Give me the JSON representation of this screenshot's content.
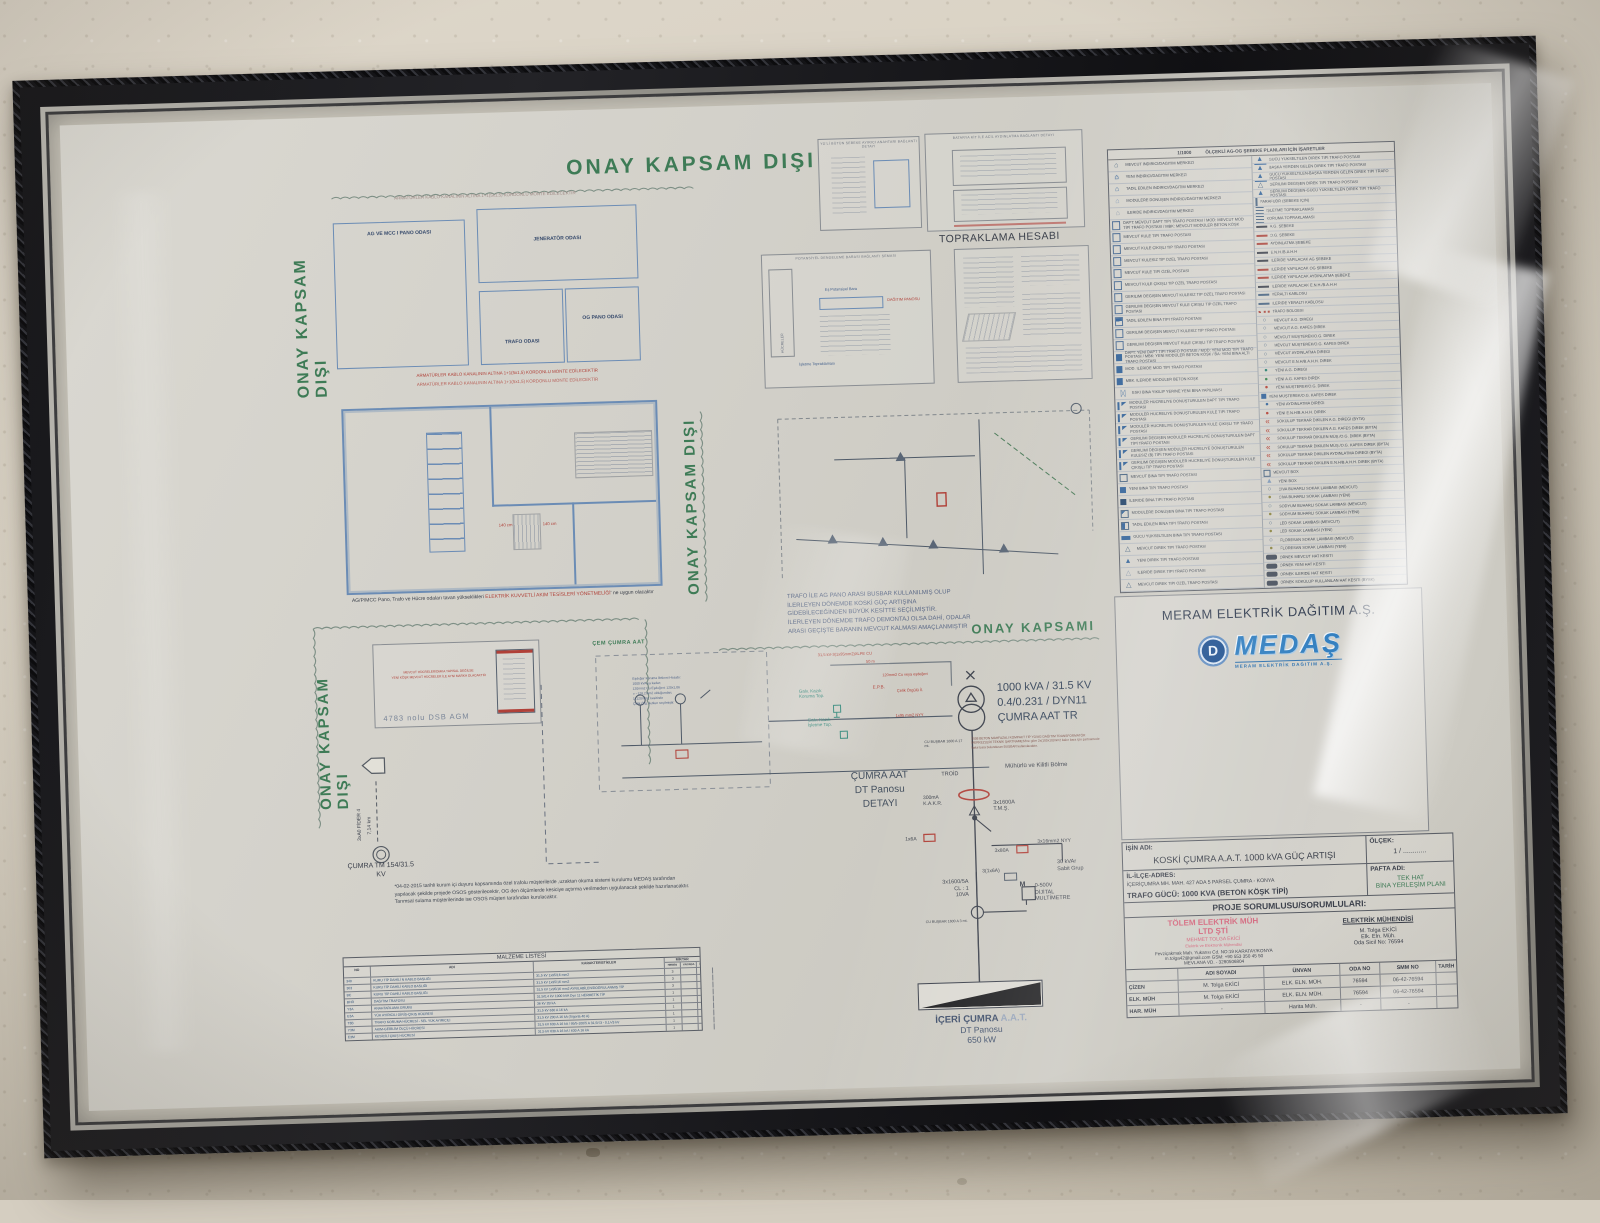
{
  "colors": {
    "stamp_green": "#3e7b56",
    "plan_blue": "#6b8cb5",
    "accent_red": "#b04038",
    "logo_blue": "#2f7dbf",
    "pink": "#d4697f"
  },
  "stamps": {
    "top": "ONAY KAPSAM DIŞI",
    "left": "ONAY KAPSAM DIŞI",
    "mid": "ONAY KAPSAM DIŞI",
    "bottom_left": "ONAY KAPSAM DIŞI",
    "scope": "ONAY KAPSAMI"
  },
  "plan1": {
    "note_top": "ARMATÜRLER KABLO KANALININ ALTINA 1+1(5x1,5) KORDONLU MONTE EDİLECEKTİR",
    "rooms": {
      "r1": "AG VE MCC I PANO ODASI",
      "r2": "JENERATÖR ODASI",
      "r3": "TRAFO ODASI",
      "r4": "OG PANO ODASI"
    },
    "note_bottom1": "ARMATÜRLER KABLO KANALININ ALTINA 1+1(5x1,5) KORDONLU MONTE EDİLECEKTİR",
    "note_bottom2": "ARMATÜRLER KABLO KANALININ ALTINA 1+1(5x1,5) KORDONLU MONTE EDİLECEKTİR"
  },
  "plan2": {
    "caption_pre": "AG/P/MCC Pano, Trafo ve Hücre odaları tavan yükseklikleri ",
    "caption_red": "ELEKTRİK KUVVETLİ AKIM TESİSLERİ YÖNETMELİĞİ",
    "caption_post": "' ne uygun olacaktır",
    "dim1": "140 cm",
    "dim2": "140 cm"
  },
  "details": {
    "box_a_title": "YG'Lİ BÜTÜN ŞEBEKE AYIRICI ANAHTARI BAĞLANTI DETAYI",
    "box_b_title": "BATARYA KİT İLE ACİL AYDINLATMA BAĞLANTI DETAYI",
    "gnd_label": "TOPRAKLAMA HESABI",
    "box_c_title": "POTANSİYEL DENGELEME BARASI BAĞLANTI ŞEMASI",
    "box_c_hucreler": "HÜCRELER",
    "box_c_bara": "Eş Potansiyel Bara",
    "box_c_pano": "DAĞITIM PANOSU",
    "box_c_gnd": "İşletme Topraklaması"
  },
  "feeder": {
    "line": "3xA0 FİDER 4",
    "len": "7,14 km",
    "tm1": "ÇUMRA TM 154/31.5",
    "tm2": "KV"
  },
  "dsb": {
    "label": "4783 nolu DSB AGM",
    "red1": "MEVCUT HÜCRELER/DMKA YAPISAL DEĞİLSE",
    "red2": "YENİ KÖŞK MEVCUT HÜCRELER İLE AYNI MARKA OLACAKTIR"
  },
  "notes_lines": [
    "TRAFO İLE AG PANO ARASI BUSBAR KULLANILMIŞ OLUP",
    "İLERLEYEN DÖNEMDE KOSKİ GÜÇ ARTIŞINA",
    "GİDEBİLECEĞİNDEN BÜYÜK KESİTTE SEÇİLMİŞTİR.",
    "İLERLEYEN DÖNEMDE TRAFO DEMONTAJ OLSA DAHİ, ODALAR",
    "ARASI GEÇİŞTE BARANIN MEVCUT KALMASI AMAÇLANMIŞTIR"
  ],
  "schematic": {
    "cem": "ÇEM ÇUMRA AAT",
    "esdeger": [
      "Eşdeğer Koruma İletkeni Hesabı:",
      "1000 kVA ya kadar;",
      "120mm2 Cu Eşdeğeri: 120x1,06",
      "= ~128,2mm2 olduğundan;",
      "1x120mm2 kesitinde",
      "Çelik Örg. iletken seçilmiştir."
    ],
    "cable_top1": "31,5 kV-3(1x95mm2)XLPE CU",
    "cable_top2": "50 m",
    "koruma1": "Galv. Kazık",
    "koruma2": "Koruma Top.",
    "epb": "E.P.B.",
    "celik": "Çelik Örgülü İl.",
    "cu120": "120mm2 Cu veya eşdeğeri",
    "isletme1": "Galv. Kazık",
    "isletme2": "İşletme Top.",
    "nyy95": "1x95 mm2 NYY",
    "spec1": "1000 kVA / 31.5 KV",
    "spec2": "0.4/0.231 / DYN11",
    "spec3": "ÇUMRA AAT TR",
    "busbar17": "CU BUŞBAR 1600 A 17 mt.",
    "sartname": "2008 BETON MAHFAZALI KOMPAKT TİP YG/AG DAĞITIM TRANSFORMATÖR MERKEZLERİ TEKNİK ŞARTNAMESİ'ne göre 2x(100x10)mm2 bakır bara için şartnamede bakır bara bulunduran BUSBAR kullanılacaktır.",
    "muhurlu": "Mühürlü ve Kilitli Bölme",
    "troid": "TROİD",
    "kakr1": "300mA",
    "kakr2": "K.A.K.R.",
    "tms1": "3x1600A",
    "tms2": "T.M.Ş.",
    "f1": "1x6A",
    "f2": "3x80A",
    "nyy16": "3x16mm2 NYY",
    "f3": "3(1x6A)",
    "mm1": "0-500V",
    "mm2": "DİJİTAL",
    "mm3": "MULTİMETRE",
    "multimeter_m": "M",
    "ct1": "3x1600/5A",
    "ct2": "CL : 1",
    "ct3": "10VA",
    "kvar1": "30 kVAr",
    "kvar2": "Sabit Grup",
    "busbar3": "CU BUŞBAR 1600 A 3 mt.",
    "dt1": "ÇUMRA AAT",
    "dt2": "DT Panosu",
    "dt3": "DETAYI"
  },
  "load": {
    "name": "İÇERİ ÇUMRA",
    "suffix": "A.A.T.",
    "line2": "DT Panosu",
    "line3": "650 kW"
  },
  "osos_note": [
    "*04-02-2015 tarihli kurum içi duyuru kapsamında özel trafolu müşterilerde ,uzaktan okuma sistemi kurulumu MEDAŞ tarafından",
    "yapılacak şekilde projede OSOS gösterilecektir, OG den ölçümlerde kesiciye açtırma verilmeden uygulanacak şekilde hazırlanacaktır.",
    "Tarımsal sulama müşterilerinde ise OSOS müşteri tarafından kurulacaktır."
  ],
  "materials": {
    "title": "MALZEME LİSTESİ",
    "h_no": "NO",
    "h_adi": "ADI",
    "h_kar": "KARAKTERİSTİKLER",
    "h_miktar": "MİKTAR",
    "h_q": [
      "HEMEN",
      "YAKINDA",
      "İLERİDE",
      "MEVCUT"
    ],
    "rows": [
      {
        "no": "340",
        "adi": "KURU TİP DAHİLİ N KABLO BAŞLIĞI",
        "kar": "31,5 kV 1x95/16 mm2",
        "q": "3"
      },
      {
        "no": "303",
        "adi": "KURU TİP DAHİLİ KABLO BAŞLIĞI",
        "kar": "31,5 kV 1x95/16 mm2",
        "q": "3"
      },
      {
        "no": "BC",
        "adi": "KURU TİP DAHİLİ KABLO BAŞLIĞI",
        "kar": "31,5 kV 1x95/16 mm2 AYRILABİLEN/DOĞRULANMIŞ TİP",
        "q": "3"
      },
      {
        "no": "BHR",
        "adi": "DAĞITIM TRAFOSU",
        "kar": "31,5/0,4 kV 1000 kVA Dyn 11 HERMETİK TİP",
        "q": "1"
      },
      {
        "no": "Y3A",
        "adi": "ANAHTARLAMA GRUBU",
        "kar": "36 kV 2B kA",
        "q": "1"
      },
      {
        "no": "E3A",
        "adi": "YÜK AYIRICILI GİRİŞ-ÇIKIŞ HÜCRESİ",
        "kar": "31,5 kV 630 A 16 kA",
        "q": "1"
      },
      {
        "no": "T3B",
        "adi": "TRAFO KORUMA HÜCRESİ - SEL YÜK AYIRICILI",
        "kar": "31,5 kV 200 A 16 kA (Sigorta 40 A)",
        "q": "1"
      },
      {
        "no": "Y3M",
        "adi": "AKIM-GERİLİM ÖLÇÜ HÜCRESİ",
        "kar": "31,5 kV 630 A 16 kA / 95/5-100/5 A 31,5/√3 - 0,1/√3 kV",
        "q": "1"
      },
      {
        "no": "E3M",
        "adi": "KESİCİLİ ÇIKIŞ HÜCRESİ",
        "kar": "31,5 kV 630 A 16 kA / 630 A 16 kA",
        "q": "1"
      }
    ]
  },
  "legend": {
    "scale": "1/1000",
    "header": "ÖLÇEKLİ AG-OG ŞEBEKE PLANLARI İÇİN İŞARETLER",
    "left": [
      {
        "icon": "house-o",
        "label": "MEVCUT İNDİRİCİ/DAĞITIM MERKEZİ"
      },
      {
        "icon": "house-f",
        "label": "YENİ İNDİRİCİ/DAĞITIM MERKEZİ"
      },
      {
        "icon": "house-h",
        "label": "TADİL EDİLEN İNDİRİCİ/DAĞITIM MERKEZİ"
      },
      {
        "icon": "house-tri",
        "label": "MODÜLERE DÖNÜŞEN İNDİRİCİ/DAĞITIM MERKEZİ"
      },
      {
        "icon": "house-d",
        "label": "İLERİDE İNDİRİCİ/DAĞITIM MERKEZİ"
      },
      {
        "icon": "kiosk-o",
        "label": "DAPT: MEVCUT DAPT TİPİ TRAFO POSTASI / MOD: MEVCUT MOD TİPİ TRAFO POSTASI / MBK: MEVCUT MODÜLER BETON KÖŞK"
      },
      {
        "icon": "kiosk-o",
        "label": "MEVCUT KULE TİPİ TRAFO POSTASI"
      },
      {
        "icon": "kiosk-o",
        "label": "MEVCUT KULE ÇIKIŞLI TİP TRAFO POSTASI"
      },
      {
        "icon": "kiosk-o",
        "label": "MEVCUT KULESİZ TİP ÖZEL TRAFO POSTASI"
      },
      {
        "icon": "kiosk-o",
        "label": "MEVCUT KULE TİPİ ÖZEL POSTASI"
      },
      {
        "icon": "kiosk-o",
        "label": "MEVCUT KULE ÇIKIŞLI TİP ÖZEL TRAFO POSTASI"
      },
      {
        "icon": "kiosk-o",
        "label": "GERİLİMİ DEĞİŞEN MEVCUT KULESİZ TİP ÖZEL TRAFO POSTASI"
      },
      {
        "icon": "kiosk-o",
        "label": "GERİLİMİ DEĞİŞEN MEVCUT KULE ÇIKIŞLI TİP ÖZEL TRAFO POSTASI"
      },
      {
        "icon": "kiosk-h",
        "label": "TADİL EDİLEN BİNA TİPİ TRAFO POSTASI"
      },
      {
        "icon": "kiosk-o",
        "label": "GERİLİMİ DEĞİŞEN MEVCUT KULESİZ TİP TRAFO POSTASI"
      },
      {
        "icon": "kiosk-o",
        "label": "GERİLİMİ DEĞİŞEN MEVCUT KULE ÇIKIŞLI TİP TRAFO POSTASI"
      },
      {
        "icon": "kiosk-f",
        "label": "DAPT: YENİ DAPT TİPİ TRAFO POSTASI / MOD: YENİ MOD TİPİ TRAFO POSTASI / MBK: YENİ MODÜLER BETON KÖŞK / BA: YENİ BİNA ALTI TRAFO POSTASI"
      },
      {
        "icon": "kiosk-f",
        "label": "MOD. İLERİDE MOD TİPİ TRAFO POSTASI"
      },
      {
        "icon": "kiosk-f",
        "label": "MBK. İLERİDE MODÜLER BETON KÖŞK"
      },
      {
        "icon": "bowtie",
        "label": "ESKİ BİNA YIKILIP YERİNE YENİ BİNA YAPILMASI"
      },
      {
        "icon": "flag",
        "label": "MODÜLER HÜCRELİYE DÖNÜŞTÜRÜLEN DAPT TİPİ TRAFO POSTASI"
      },
      {
        "icon": "flag",
        "label": "MODÜLER HÜCRELİYE DÖNÜŞTÜRÜLEN KULE TİPİ TRAFO POSTASI"
      },
      {
        "icon": "flag",
        "label": "MODÜLER HÜCRELİYE DÖNÜŞTÜRÜLEN KULE ÇIKIŞLI TİP TRAFO POSTASI"
      },
      {
        "icon": "flag",
        "label": "GERİLİMİ DEĞİŞEN MODÜLER HÜCRELİYE DÖNÜŞTÜRÜLEN DAPT TİPİ TRAFO POSTASI"
      },
      {
        "icon": "flag",
        "label": "GERİLİMİ DEĞİŞEN MODÜLER HÜCRELİYE DÖNÜŞTÜRÜLEN KULESİZ (B) TİPİ TRAFO POSTASI"
      },
      {
        "icon": "flag",
        "label": "GERİLİMİ DEĞİŞEN MODÜLER HÜCRELİYE DÖNÜŞTÜRÜLEN KULE ÇIKIŞLI TİP TRAFO POSTASI"
      },
      {
        "icon": "sq-o",
        "label": "MEVCUT BİNA TİPİ TRAFO POSTASI"
      },
      {
        "icon": "sq-f",
        "label": "YENİ BİNA TİPİ TRAFO POSTASI"
      },
      {
        "icon": "sq-fd",
        "label": "İLERİDE BİNA TİPİ TRAFO POSTASI"
      },
      {
        "icon": "sq-tri",
        "label": "MODÜLERE DÖNÜŞEN BİNA TİPİ TRAFO POSTASI"
      },
      {
        "icon": "sq-h",
        "label": "TADİL EDİLEN BİNA TİPİ TRAFO POSTASI"
      },
      {
        "icon": "sq-bar",
        "label": "GÜCÜ YÜKSELTİLEN BİNA TİPİ TRAFO POSTASI"
      },
      {
        "icon": "tri-o",
        "label": "MEVCUT DİREK TİPİ TRAFO POSTASI"
      },
      {
        "icon": "tri-f",
        "label": "YENİ DİREK TİPİ TRAFO POSTASI"
      },
      {
        "icon": "tri-d",
        "label": "İLERİDE DİREK TİPİ TRAFO POSTASI"
      },
      {
        "icon": "tri-o",
        "label": "MEVCUT DİREK TİPİ ÖZEL TRAFO POSTASI"
      }
    ],
    "right": [
      {
        "icon": "tri-bar",
        "label": "GÜCÜ YÜKSELTİLEN DİREK TİPİ TRAFO POSTASI"
      },
      {
        "icon": "tri-f",
        "label": "BAŞKA YERDEN GELEN DİREK TİPİ TRAFO POSTASI"
      },
      {
        "icon": "tri-bar",
        "label": "GÜCÜ YÜKSELTİLEN-BAŞKA YERDEN GELEN DİREK TİPİ TRAFO POSTASI"
      },
      {
        "icon": "tri-o",
        "label": "GERİLİMİ DEĞİŞEN DİREK TİPİ TRAFO POSTASI"
      },
      {
        "icon": "tri-f",
        "label": "GERİLİMİ DEĞİŞEN-GÜCÜ YÜKSELTİLEN DİREK TİPİ TRAFO POSTASI"
      },
      {
        "icon": "para",
        "label": "PARAFUDR (ŞEBEKE İÇİN)"
      },
      {
        "icon": "gnd",
        "label": "İŞLETME TOPRAKLAMASI"
      },
      {
        "icon": "gnd",
        "label": "KORUMA TOPRAKLAMASI"
      },
      {
        "icon": "line-d",
        "label": "A.G. ŞEBEKE"
      },
      {
        "icon": "line-r",
        "label": "O.G. ŞEBEKE"
      },
      {
        "icon": "line-r",
        "label": "AYDINLATMA ŞEBEKE"
      },
      {
        "icon": "line-d",
        "label": "E.N.H./B.A.H.H"
      },
      {
        "icon": "dash-d",
        "label": "İLERİDE YAPILACAK AG ŞEBEKE"
      },
      {
        "icon": "dash-r",
        "label": "İLERİDE YAPILACAK OG ŞEBEKE"
      },
      {
        "icon": "dash-r",
        "label": "İLERİDE YAPILACAK AYDINLATMA ŞEBEKE"
      },
      {
        "icon": "dash-d",
        "label": "İLERİDE YAPILACAK E.N.H./B.A.H.H"
      },
      {
        "icon": "dash-m",
        "label": "YERALTI KABLOSU"
      },
      {
        "icon": "dash-m",
        "label": "İLERİDE YERALTI KABLOSU"
      },
      {
        "icon": "dot-l",
        "label": "TRAFO BÖLGESİ"
      },
      {
        "icon": "circ",
        "label": "MEVCUT A.G. DİREĞİ"
      },
      {
        "icon": "circ",
        "label": "MEVCUT A.G. KAFES DİREK"
      },
      {
        "icon": "circ",
        "label": "MEVCUT MÜŞTEREK/O.G. DİREK"
      },
      {
        "icon": "circ",
        "label": "MEVCUT MÜŞTEREK/O.G. KAFES DİREK"
      },
      {
        "icon": "circ",
        "label": "MEVCUT AYDINLATMA DİREĞİ"
      },
      {
        "icon": "circ",
        "label": "MEVCUT E.N.H/B.A.H.H. DİREK"
      },
      {
        "icon": "dot-t",
        "label": "YENİ A.G. DİREĞİ"
      },
      {
        "icon": "dot-g",
        "label": "YENİ A.G. KAFES DİREK"
      },
      {
        "icon": "dot-r",
        "label": "YENİ MÜŞTEREK/O.G. DİREK"
      },
      {
        "icon": "sq-f-sm",
        "label": "YENİ MÜŞTEREK/O.G. KAFES DİREK"
      },
      {
        "icon": "dot-b",
        "label": "YENİ AYDINLATMA DİREĞİ"
      },
      {
        "icon": "dot-r",
        "label": "YENİ E.N.H/B.A.H.H. DİREK"
      },
      {
        "icon": "chev",
        "label": "SÖKÜLÜP TEKRAR DİKİLEN A.G. DİREĞİ (BYTA)"
      },
      {
        "icon": "chev",
        "label": "SÖKÜLÜP TEKRAR DİKİLEN A.G. KAFES DİREK (BYTA)"
      },
      {
        "icon": "chev",
        "label": "SÖKÜLÜP TEKRAR DİKİLEN MÜŞ./O.G. DİREK (BYTA)"
      },
      {
        "icon": "chev",
        "label": "SÖKÜLÜP TEKRAR DİKİLEN MÜŞ./O.G. KAFES DİREK (BYTA)"
      },
      {
        "icon": "chev",
        "label": "SÖKÜLÜP TEKRAR DİKİLEN AYDINLATMA DİREĞİ (BYTA)"
      },
      {
        "icon": "chev",
        "label": "SÖKÜLÜP TEKRAR DİKİLEN E.N.H/B.A.H.H. DİREK (BYTA)"
      },
      {
        "icon": "sq-o-sm",
        "label": "MEVCUT BOX"
      },
      {
        "icon": "tri-h",
        "label": "YENİ BOX"
      },
      {
        "icon": "circ",
        "label": "CİVA BUHARLI SOKAK LAMBASI (MEVCUT)"
      },
      {
        "icon": "dot-y",
        "label": "CİVA BUHARLI SOKAK LAMBASI (YENİ)"
      },
      {
        "icon": "circ",
        "label": "SODYUM BUHARLI SOKAK LAMBASI (MEVCUT)"
      },
      {
        "icon": "dot-y",
        "label": "SODYUM BUHARLI SOKAK LAMBASI (YENİ)"
      },
      {
        "icon": "circ",
        "label": "LED SOKAK LAMBASI (MEVCUT)"
      },
      {
        "icon": "dot-y",
        "label": "LED SOKAK LAMBASI (YENİ)"
      },
      {
        "icon": "circ",
        "label": "FLORESAN SOKAK LAMBASI (MEVCUT)"
      },
      {
        "icon": "dot-y",
        "label": "FLORESAN SOKAK LAMBASI (YENİ)"
      },
      {
        "icon": "chip",
        "label": "ÖRNEK MEVCUT HAT KESİTİ"
      },
      {
        "icon": "chip",
        "label": "ÖRNEK YENİ HAT KESİTİ"
      },
      {
        "icon": "chip",
        "label": "ÖRNEK İLERİDE HAT KESİTİ"
      },
      {
        "icon": "chip",
        "label": "ÖRNEK SÖKÜLÜP KULLANILAN HAT KESİTİ (BYSK)"
      }
    ]
  },
  "company": {
    "title": "MERAM ELEKTRİK DAĞITIM A.Ş.",
    "logo": "MEDAŞ",
    "emblem_letter": "D",
    "tagline": "MERAM ELEKTRİK DAĞITIM A.Ş."
  },
  "titleblock": {
    "isin_adi_label": "İŞİN ADI:",
    "isin_adi": "KOSKİ ÇUMRA A.A.T. 1000 kVA  GÜÇ ARTIŞI",
    "olcek_label": "ÖLÇEK:",
    "olcek": "1 / ............",
    "adres_label": "İL-İLÇE-ADRES:",
    "adres": "İÇERİÇUMRA MH. MAH. 427 ADA 5 PARSEL ÇUMRA - KONYA",
    "pafta_label": "PAFTA ADI:",
    "pafta1": "TEK HAT",
    "pafta2": "BİNA YERLEŞİM PLANI",
    "trafo": "TRAFO GÜCÜ: 1000 KVA (BETON KÖŞK TİPİ)",
    "sorumlu_header": "PROJE SORUMLUSU/SORUMLULARI:",
    "firm1": "TÖLEM ELEKTRİK MÜH",
    "firm2": "LTD ŞTİ",
    "firm3": "MEHMET TOLGA EKİCİ",
    "firm4": "Elektrik ve Elektronik Mühendisi",
    "addr1": "Fevziçakmak Mah. Yukarısı Cd. NO:19 KARATAY/KONYA",
    "addr2": "m.tolga42@gmail.com GSM: +90 553 350 45 50",
    "addr3": "MEVLANA VD. - 3280506804",
    "eng_title": "ELEKTRİK MÜHENDİSİ",
    "eng1": "M. Tolga EKİCİ",
    "eng2": "Elk. Eln. Müh.",
    "eng3": "Oda Sicil No: 76594"
  },
  "sign_table": {
    "headers": [
      "",
      "ADI SOYADI",
      "ÜNVAN",
      "ODA NO",
      "SMM NO",
      "TARİH"
    ],
    "rows": [
      {
        "c0": "ÇİZEN",
        "c1": "M. Tolga EKİCİ",
        "c2": "ELK. ELN. MÜH.",
        "c3": "76594",
        "c4": "06-42-76594",
        "c5": ""
      },
      {
        "c0": "ELK. MÜH",
        "c1": "M. Tolga EKİCİ",
        "c2": "ELK. ELN. MÜH.",
        "c3": "76594",
        "c4": "06-42-76594",
        "c5": ""
      },
      {
        "c0": "HAR. MÜH",
        "c1": "-",
        "c2": "Harita Müh.",
        "c3": "-",
        "c4": "-",
        "c5": ""
      }
    ]
  }
}
